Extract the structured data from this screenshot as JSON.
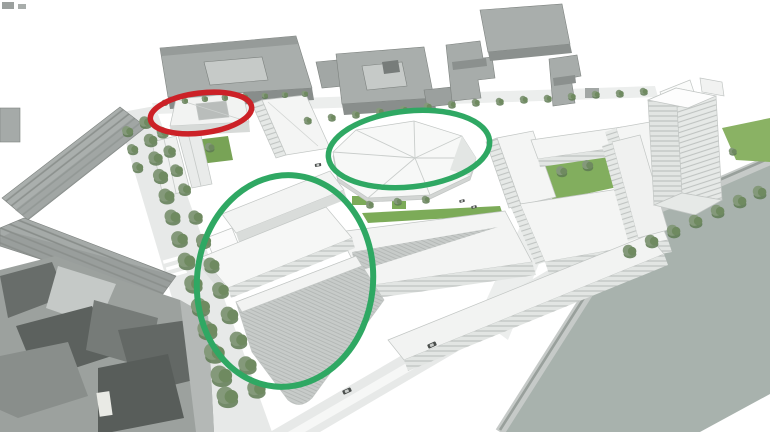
{
  "meta": {
    "description": "Aerial 3D massing rendering of an urban waterfront development site: grey existing city blocks on the left and top, white proposed buildings in the centre, tree-lined streets, and a river along the lower right. Three hand-drawn annotation ellipses highlight areas of the proposal.",
    "image_type": "architectural massing diagram with annotation circles",
    "visible_text": "none"
  },
  "colors": {
    "background": "#ffffff",
    "water": "#a8b2ad",
    "shore_wall": "#99a09c",
    "road": "#e7e9e8",
    "lawn": "#82ae5e",
    "lawn_bright": "#7cab58",
    "tree_mid": "#84997a",
    "gray_building_roof": "#aaafad",
    "gray_building_face": "#8b908e",
    "dark_block": "#5c615e",
    "white_building": "#f4f5f4",
    "annotation_red": "#cc2127",
    "annotation_green": "#2fa863"
  },
  "annotations": [
    {
      "name": "annotation-red-ellipse",
      "target": "small courtyard building at the north edge of the site",
      "shape": "ellipse",
      "cx": 201,
      "cy": 113,
      "rx": 51,
      "ry": 20,
      "rotation": -7,
      "color": "#cc2127",
      "stroke_width": 5.5
    },
    {
      "name": "annotation-green-ellipse-pavilion",
      "target": "pavilion building with faceted folded roof",
      "shape": "ellipse",
      "cx": 409,
      "cy": 149,
      "rx": 81,
      "ry": 38,
      "rotation": -6,
      "color": "#2fa863",
      "stroke_width": 5.5
    },
    {
      "name": "annotation-green-ellipse-main-blocks",
      "target": "main cluster of proposed white development slabs",
      "shape": "ellipse",
      "cx": 285,
      "cy": 281,
      "rx": 88,
      "ry": 106,
      "rotation": 6,
      "color": "#2fa863",
      "stroke_width": 6
    }
  ],
  "scene": {
    "regions": [
      {
        "name": "river",
        "position": "bottom-right",
        "fill_ref": "water"
      },
      {
        "name": "riverside-promenade-with-trees",
        "position": "along river"
      },
      {
        "name": "existing-grey-terraces",
        "position": "left"
      },
      {
        "name": "existing-dense-grey-block",
        "position": "bottom-left"
      },
      {
        "name": "existing-grey-perimeter-blocks",
        "position": "top"
      },
      {
        "name": "proposed-white-buildings",
        "position": "centre"
      },
      {
        "name": "white-tower",
        "position": "right"
      },
      {
        "name": "tree-lined-street",
        "position": "left of proposed blocks"
      },
      {
        "name": "courtyard-lawns",
        "position": "inside white blocks"
      }
    ],
    "vehicles": {
      "cars_on_roads": 5
    }
  }
}
